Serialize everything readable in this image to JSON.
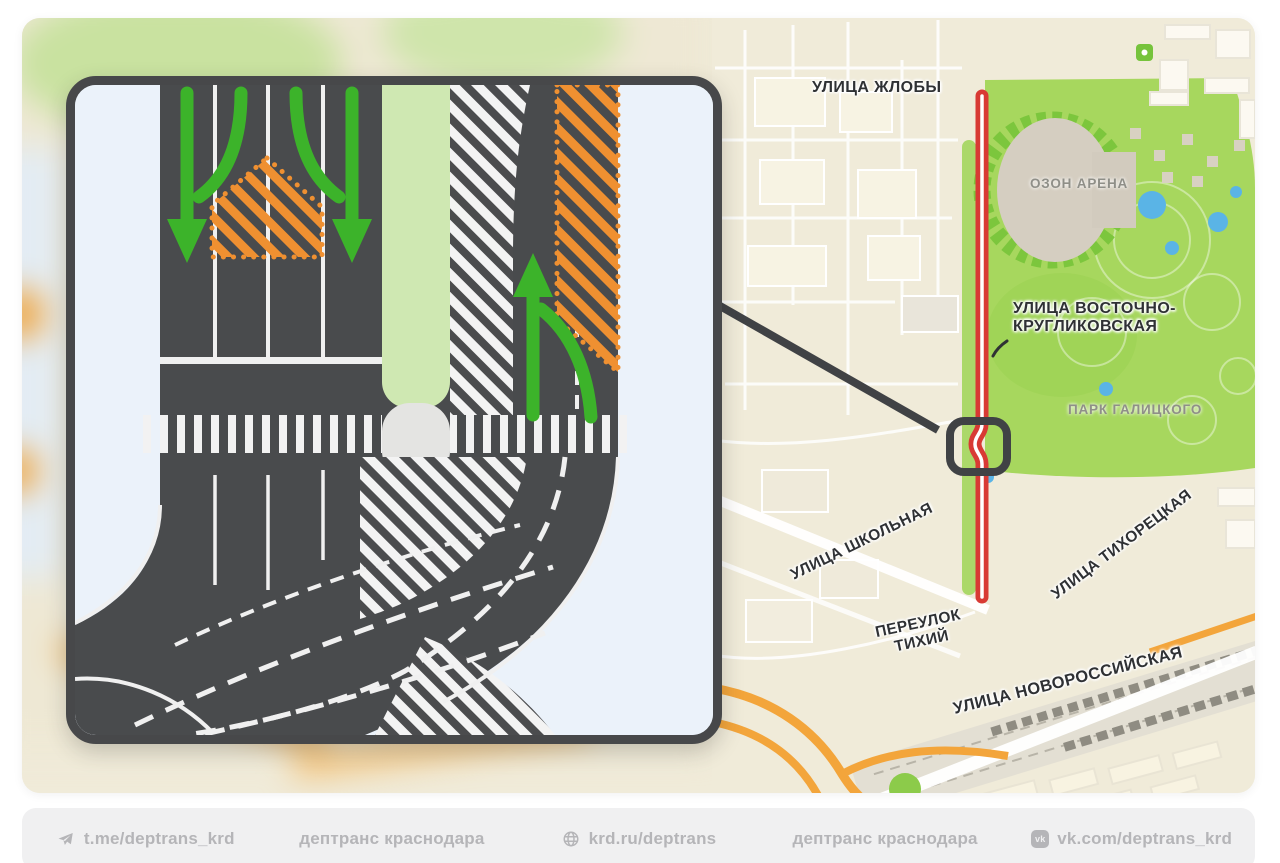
{
  "map": {
    "labels": {
      "zhloby": "УЛИЦА ЖЛОБЫ",
      "vostochno_line1": "УЛИЦА ВОСТОЧНО-",
      "vostochno_line2": "КРУГЛИКОВСКАЯ",
      "arena": "ОЗОН АРЕНА",
      "park": "ПАРК ГАЛИЦКОГО",
      "shkolnaya": "УЛИЦА ШКОЛЬНАЯ",
      "pereulok_line1": "ПЕРЕУЛОК",
      "pereulok_line2": "ТИХИЙ",
      "tikhoretskaya": "УЛИЦА ТИХОРЕЦКАЯ",
      "novorossiyskaya": "УЛИЦА НОВОРОССИЙСКАЯ"
    },
    "highlight": {
      "route_color": "#d83a34",
      "route_street": "УЛИЦА ВОСТОЧНО-КРУГЛИКОВСКАЯ"
    },
    "callout": {
      "marker_color": "#404245"
    }
  },
  "diagram": {
    "closed_area_color": "#ef9031",
    "allowed_direction_color": "#3cb32a",
    "road_color": "#494b4d",
    "median_green": "#cfe8b2"
  },
  "footer": {
    "items": [
      {
        "icon": "telegram",
        "label": "t.me/deptrans_krd"
      },
      {
        "icon": "",
        "label": "дептранс краснодара"
      },
      {
        "icon": "globe",
        "label": "krd.ru/deptrans"
      },
      {
        "icon": "",
        "label": "дептранс краснодара"
      },
      {
        "icon": "vk",
        "label": "vk.com/deptrans_krd"
      }
    ]
  }
}
